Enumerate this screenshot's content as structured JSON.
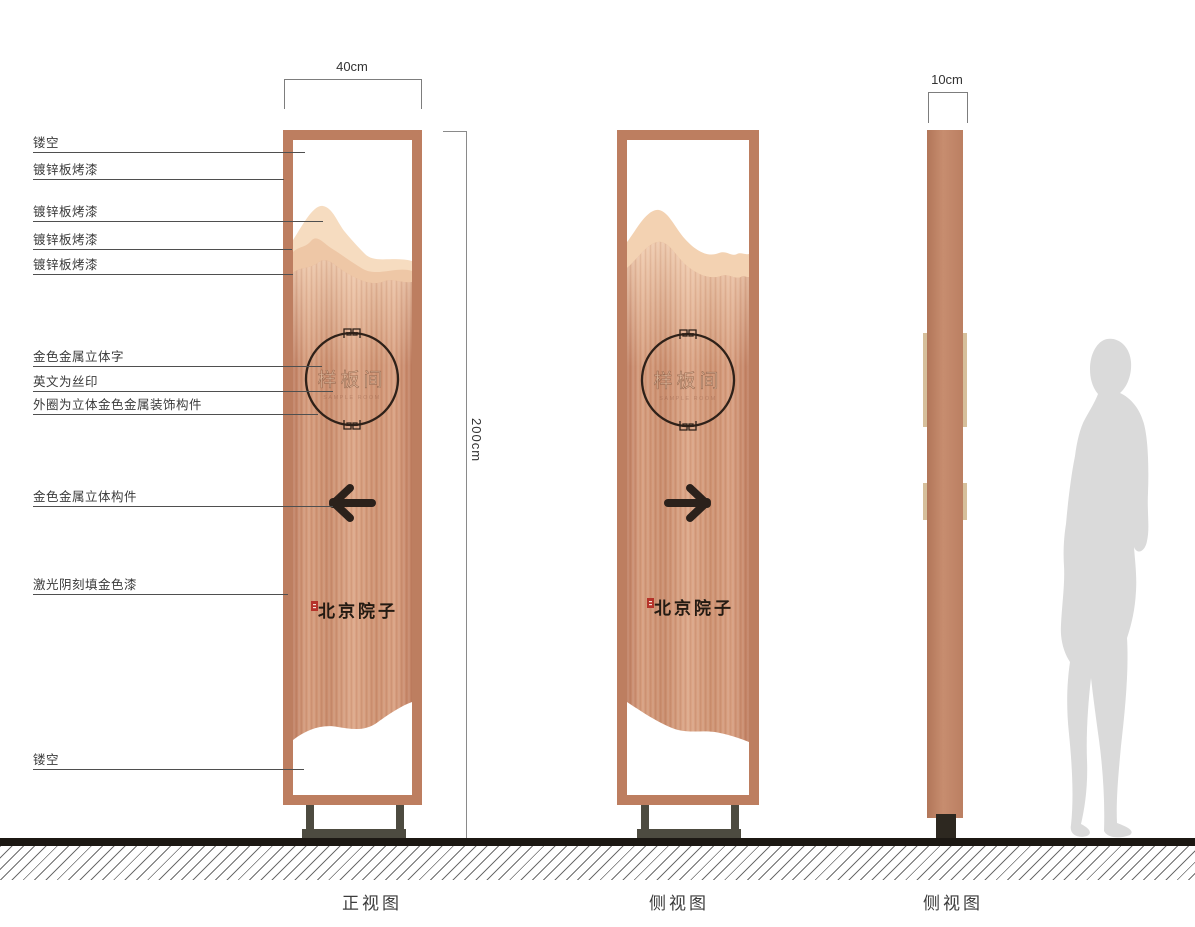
{
  "drawing": {
    "dimensions": {
      "width": "40cm",
      "thickness": "10cm",
      "height": "200cm"
    },
    "annotations": [
      {
        "label": "镂空"
      },
      {
        "label": "镀锌板烤漆"
      },
      {
        "label": "镀锌板烤漆"
      },
      {
        "label": "镀锌板烤漆"
      },
      {
        "label": "镀锌板烤漆"
      },
      {
        "label": "金色金属立体字"
      },
      {
        "label": "英文为丝印"
      },
      {
        "label": "外圈为立体金色金属装饰构件"
      },
      {
        "label": "金色金属立体构件"
      },
      {
        "label": "激光阴刻填金色漆"
      },
      {
        "label": "镂空"
      }
    ],
    "sign": {
      "room_label": "样板间",
      "room_label_en": "SAMPLE ROOM",
      "brand": "北京院子"
    },
    "captions": {
      "front": "正视图",
      "side1": "侧视图",
      "side2": "侧视图"
    },
    "colors": {
      "frame": "#bd7e60",
      "panel": "#d3997a",
      "accent_dark": "#2b211b",
      "tab_gold": "#d6bf9b",
      "seal_red": "#b5332a",
      "silhouette": "#dadada"
    }
  }
}
